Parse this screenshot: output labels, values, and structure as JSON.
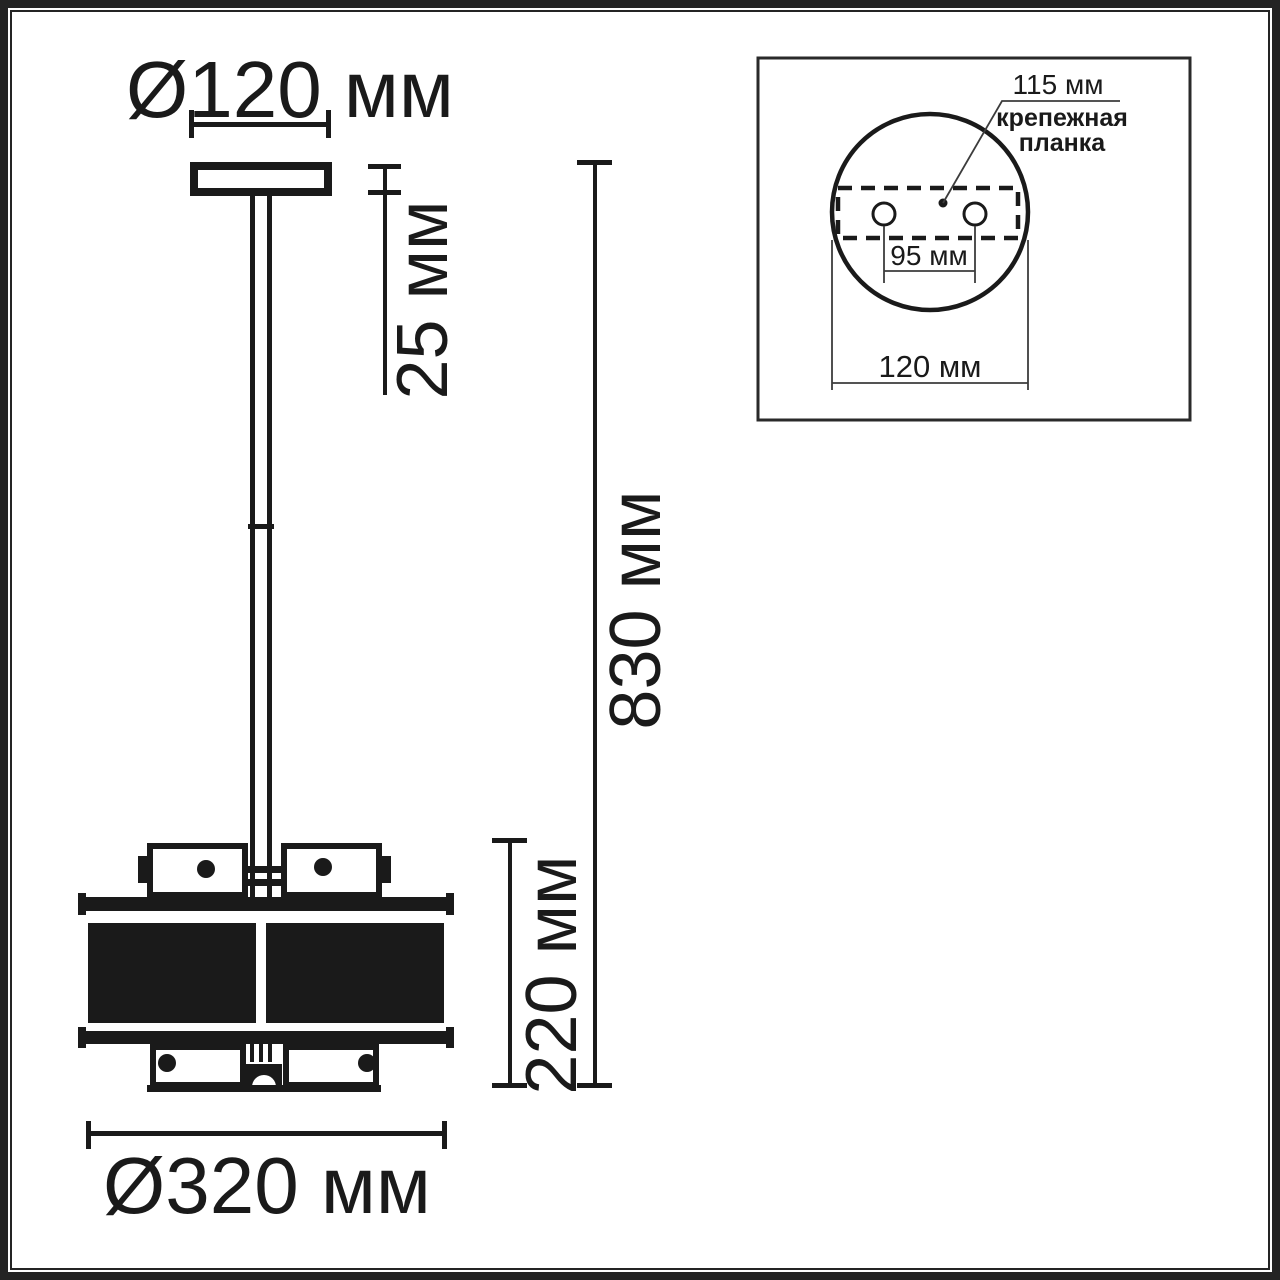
{
  "main_view": {
    "canopy_diameter": "Ø120 мм",
    "canopy_height": "25 мм",
    "total_height": "830 мм",
    "shade_height": "220 мм",
    "shade_diameter": "Ø320 мм"
  },
  "inset_view": {
    "plate_length": "115 мм",
    "plate_label_line1": "крепежная",
    "plate_label_line2": "планка",
    "hole_spacing": "95 мм",
    "canopy_diameter": "120 мм"
  },
  "colors": {
    "line": "#1a1a1a",
    "thin_line": "#3c3c3c",
    "background": "#ffffff"
  }
}
